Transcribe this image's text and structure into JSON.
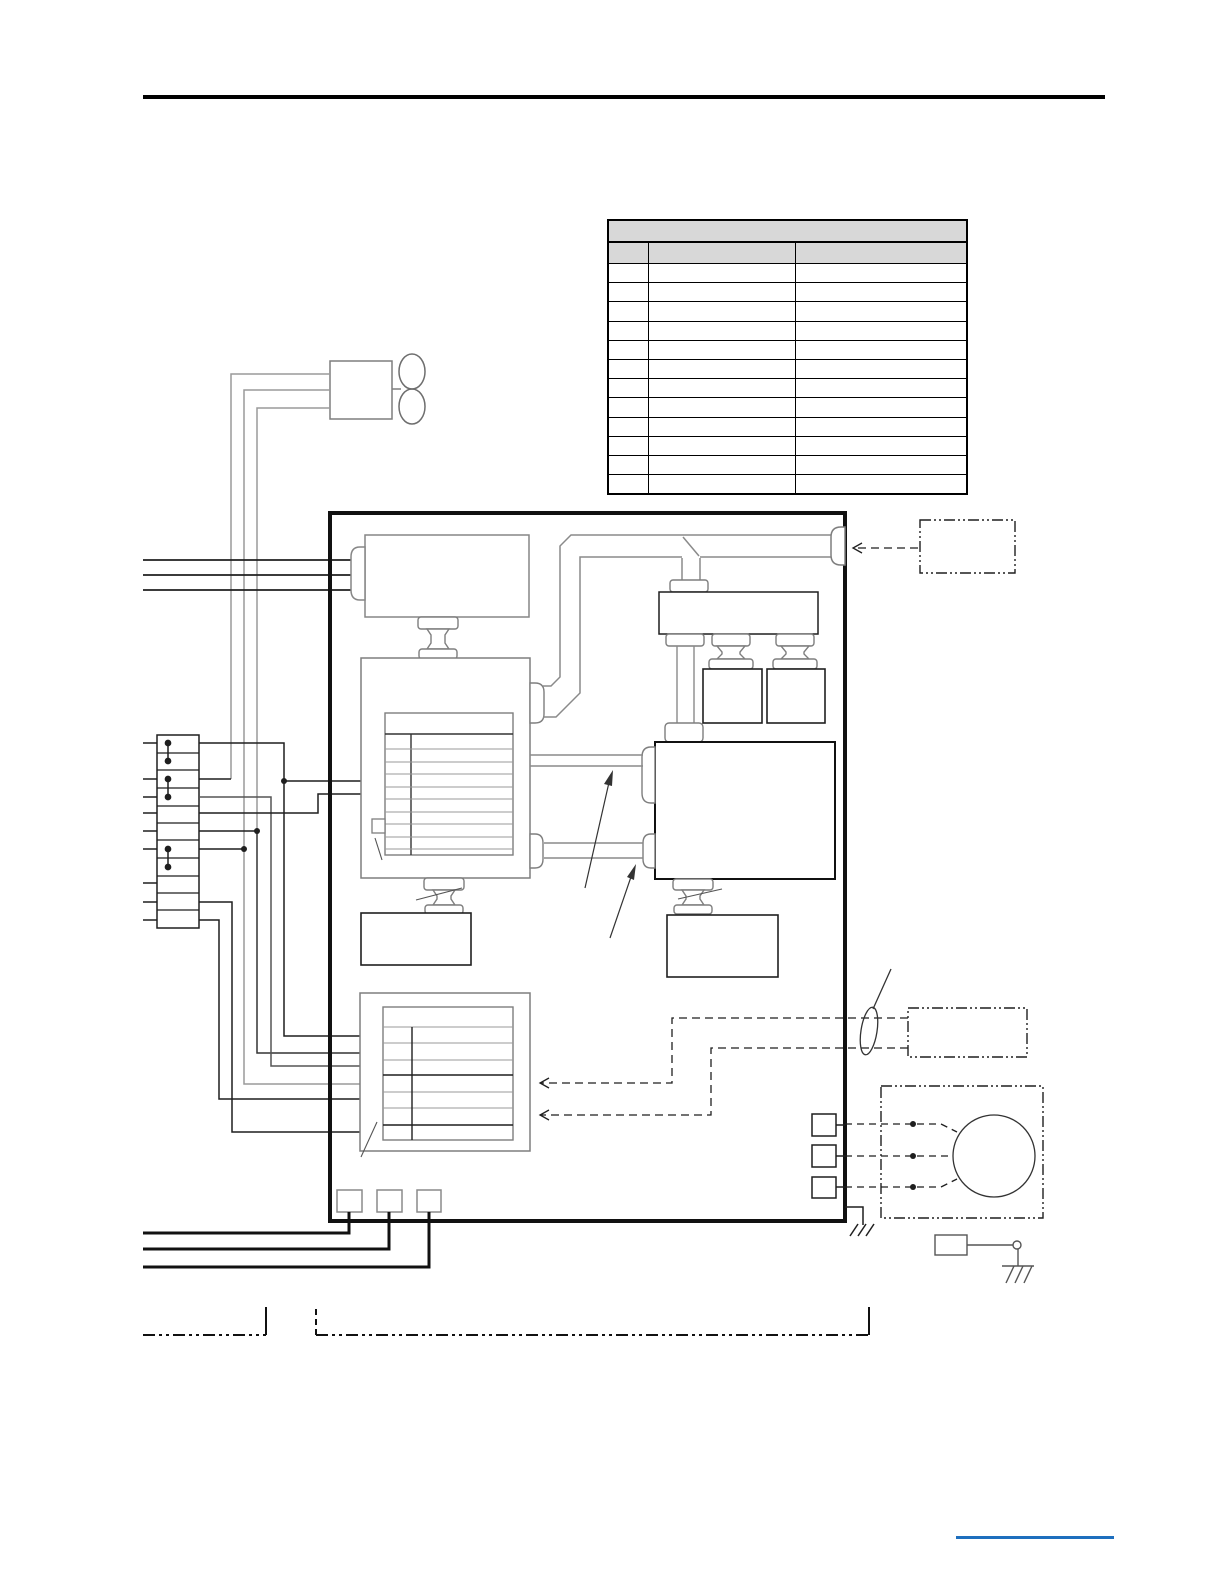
{
  "page": {
    "background": "#ffffff"
  },
  "colors": {
    "header_rule": "#000000",
    "diagram_line_black": "#1f1f1f",
    "diagram_line_gray": "#9a9a9a",
    "diagram_shape_gray": "#7e7e7e",
    "table_border": "#000000",
    "table_header_fill": "#d8d8d8",
    "main_unit_border": "#111111",
    "footer_rule_blue": "#1e6fbe"
  },
  "table": {
    "title": "",
    "columns": [
      "",
      "",
      ""
    ],
    "row_count": 12,
    "cell_text": ""
  }
}
